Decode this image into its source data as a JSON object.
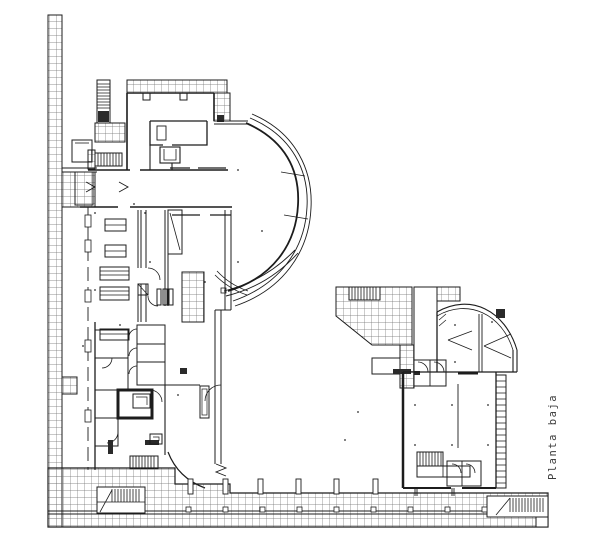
{
  "drawing": {
    "label": "Planta baja",
    "colors": {
      "background": "#ffffff",
      "line": "#1c1c1c",
      "hatch": "#6e6e6e"
    }
  }
}
